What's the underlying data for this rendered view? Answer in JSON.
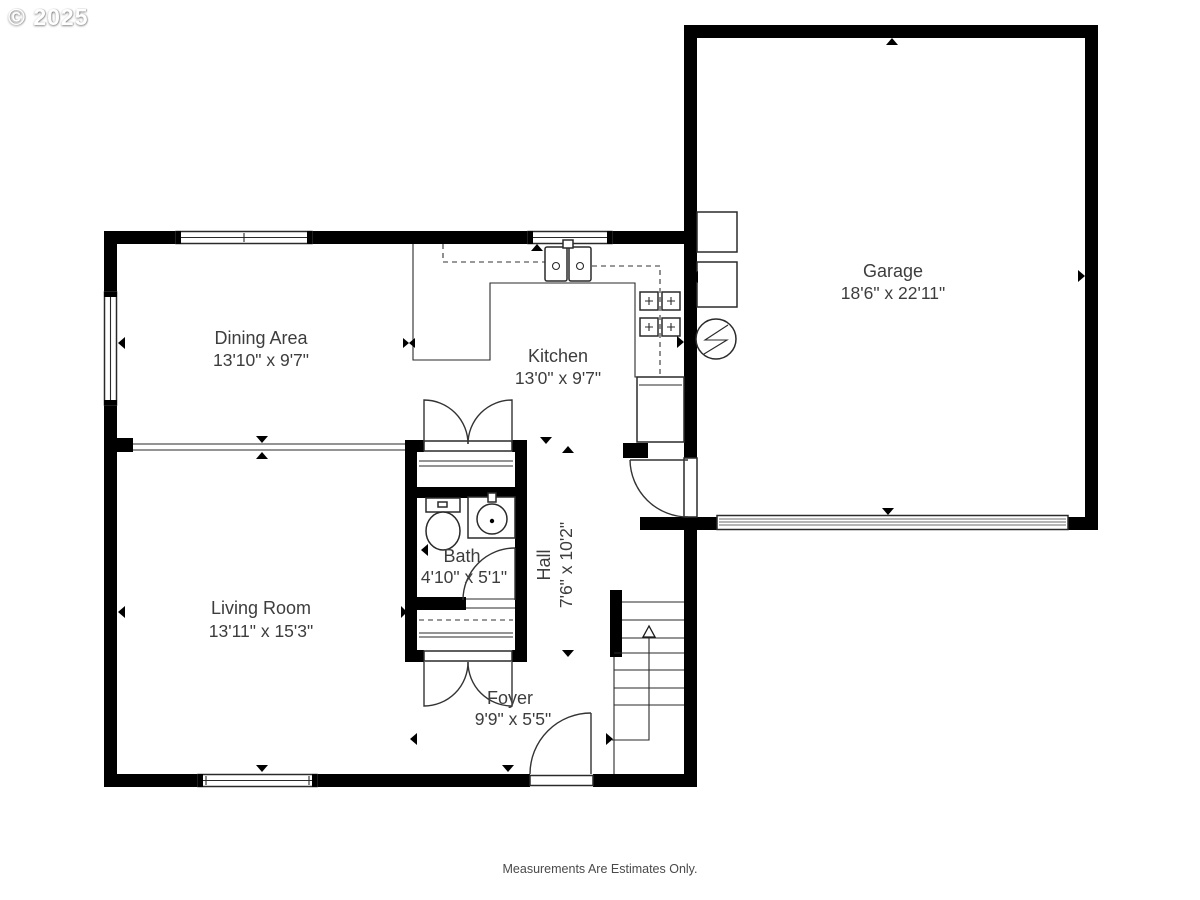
{
  "watermark": "© 2025",
  "footer": {
    "disclaimer": "Measurements Are Estimates Only."
  },
  "rooms": {
    "dining": {
      "name": "Dining Area",
      "dims": "13'10\" x 9'7\""
    },
    "kitchen": {
      "name": "Kitchen",
      "dims": "13'0\" x 9'7\""
    },
    "garage": {
      "name": "Garage",
      "dims": "18'6\" x 22'11\""
    },
    "living": {
      "name": "Living Room",
      "dims": "13'11\" x 15'3\""
    },
    "bath": {
      "name": "Bath",
      "dims": "4'10\" x 5'1\""
    },
    "hall": {
      "name": "Hall",
      "dims": "7'6\" x 10'2\""
    },
    "foyer": {
      "name": "Foyer",
      "dims": "9'9\" x 5'5\""
    }
  },
  "colors": {
    "wall": "#000000",
    "line": "#2a2a2a",
    "text": "#3d3d3d"
  },
  "icons": [
    "toilet-icon",
    "vanity-sink-icon",
    "kitchen-sink-icon",
    "stove-icon",
    "fridge-icon",
    "water-heater-icon",
    "furnace-icon",
    "electrical-panel-icon",
    "stairs-up-arrow-icon",
    "garage-door-icon"
  ]
}
